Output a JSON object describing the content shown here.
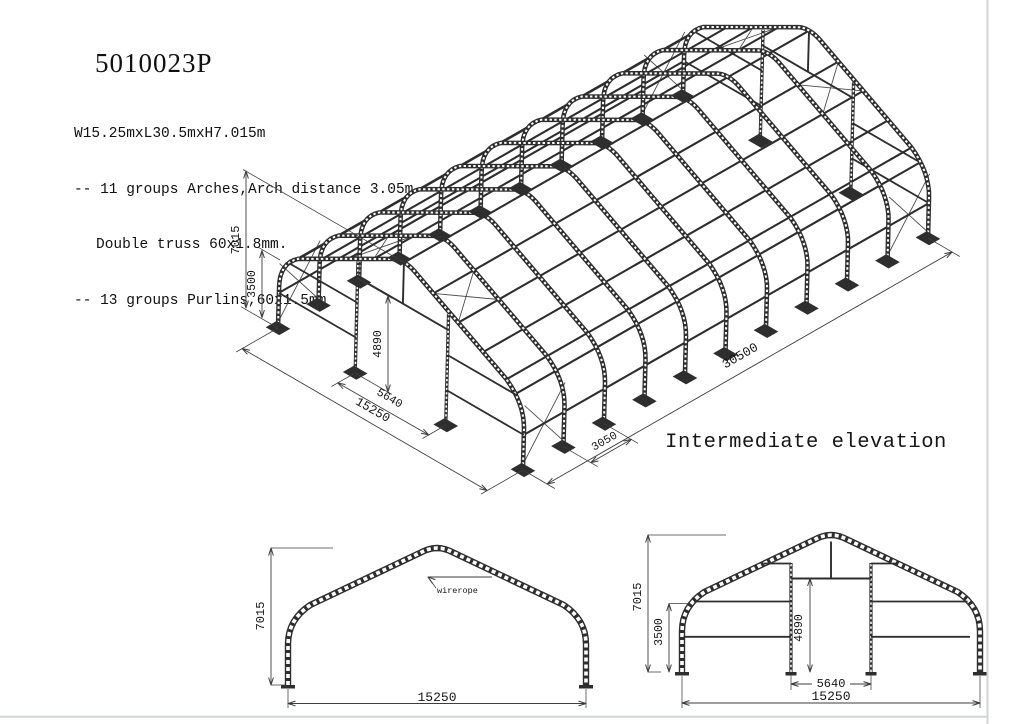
{
  "page": {
    "title": "5010023P",
    "spec_lines": [
      "W15.25mxL30.5mxH7.015m",
      "-- 11 groups Arches,Arch distance 3.05m",
      "Double truss 60x1.8mm.",
      "-- 13 groups Purlins,60x1.5mm"
    ]
  },
  "views": {
    "iso": {
      "label": "Intermediate elevation",
      "dims": {
        "height": "7015",
        "leg": "3500",
        "door_height": "4890",
        "door_width": "5640",
        "span": "15250",
        "bay": "3050",
        "length": "30500"
      }
    },
    "side_elevation": {
      "annotation": "wirerope",
      "dims": {
        "height": "7015",
        "span": "15250"
      }
    },
    "end_elevation": {
      "dims": {
        "height": "7015",
        "leg": "3500",
        "door_height": "4890",
        "door_width": "5640",
        "span": "15250"
      }
    }
  },
  "geometry": {
    "span_m": 15.25,
    "length_m": 30.5,
    "height_m": 7.015,
    "leg_m": 3.5,
    "bay_m": 3.05,
    "arch_count": 11,
    "purlin_count": 13,
    "door_width_m": 5.64,
    "door_height_m": 4.89
  },
  "colors": {
    "ink": "#2e2e2e",
    "dim": "#3d3d3d",
    "text": "#161616",
    "page_edge": "#d2d5d7"
  }
}
